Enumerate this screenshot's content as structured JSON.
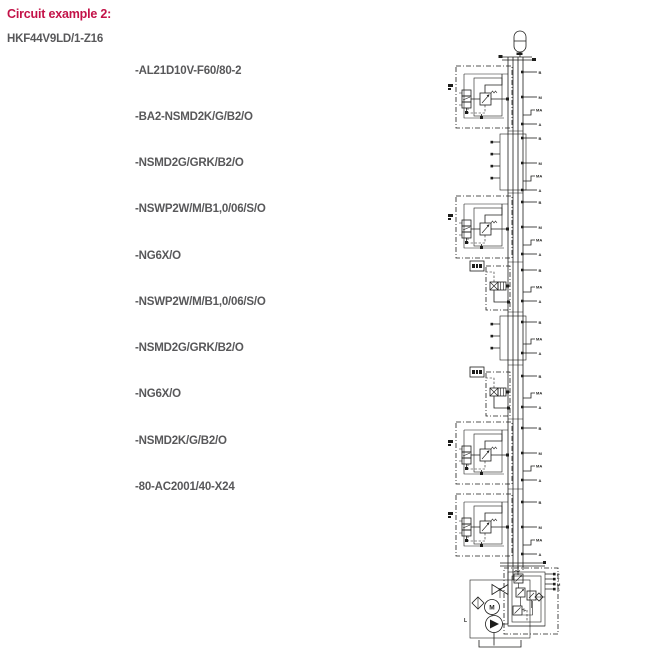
{
  "page": {
    "title": "Circuit example 2:",
    "part_number": "HKF44V9LD/1-Z16",
    "components": [
      "-AL21D10V-F60/80-2",
      "-BA2-NSMD2K/G/B2/O",
      "-NSMD2G/GRK/B2/O",
      "-NSWP2W/M/B1,0/06/S/O",
      "-NG6X/O",
      "-NSWP2W/M/B1,0/06/S/O",
      "-NSMD2G/GRK/B2/O",
      "-NG6X/O",
      "-NSMD2K/G/B2/O",
      "-80-AC2001/40-X24"
    ]
  },
  "colors": {
    "title_red": "#c31248",
    "body_text": "#58585a",
    "diagram_line": "#1d1d1b"
  },
  "diagram": {
    "type": "hydraulic-circuit-schematic",
    "port_labels": {
      "b": "B",
      "a": "A",
      "ma": "MA",
      "m": "M",
      "p": "P",
      "t": "T",
      "s": "S",
      "l": "L"
    }
  }
}
